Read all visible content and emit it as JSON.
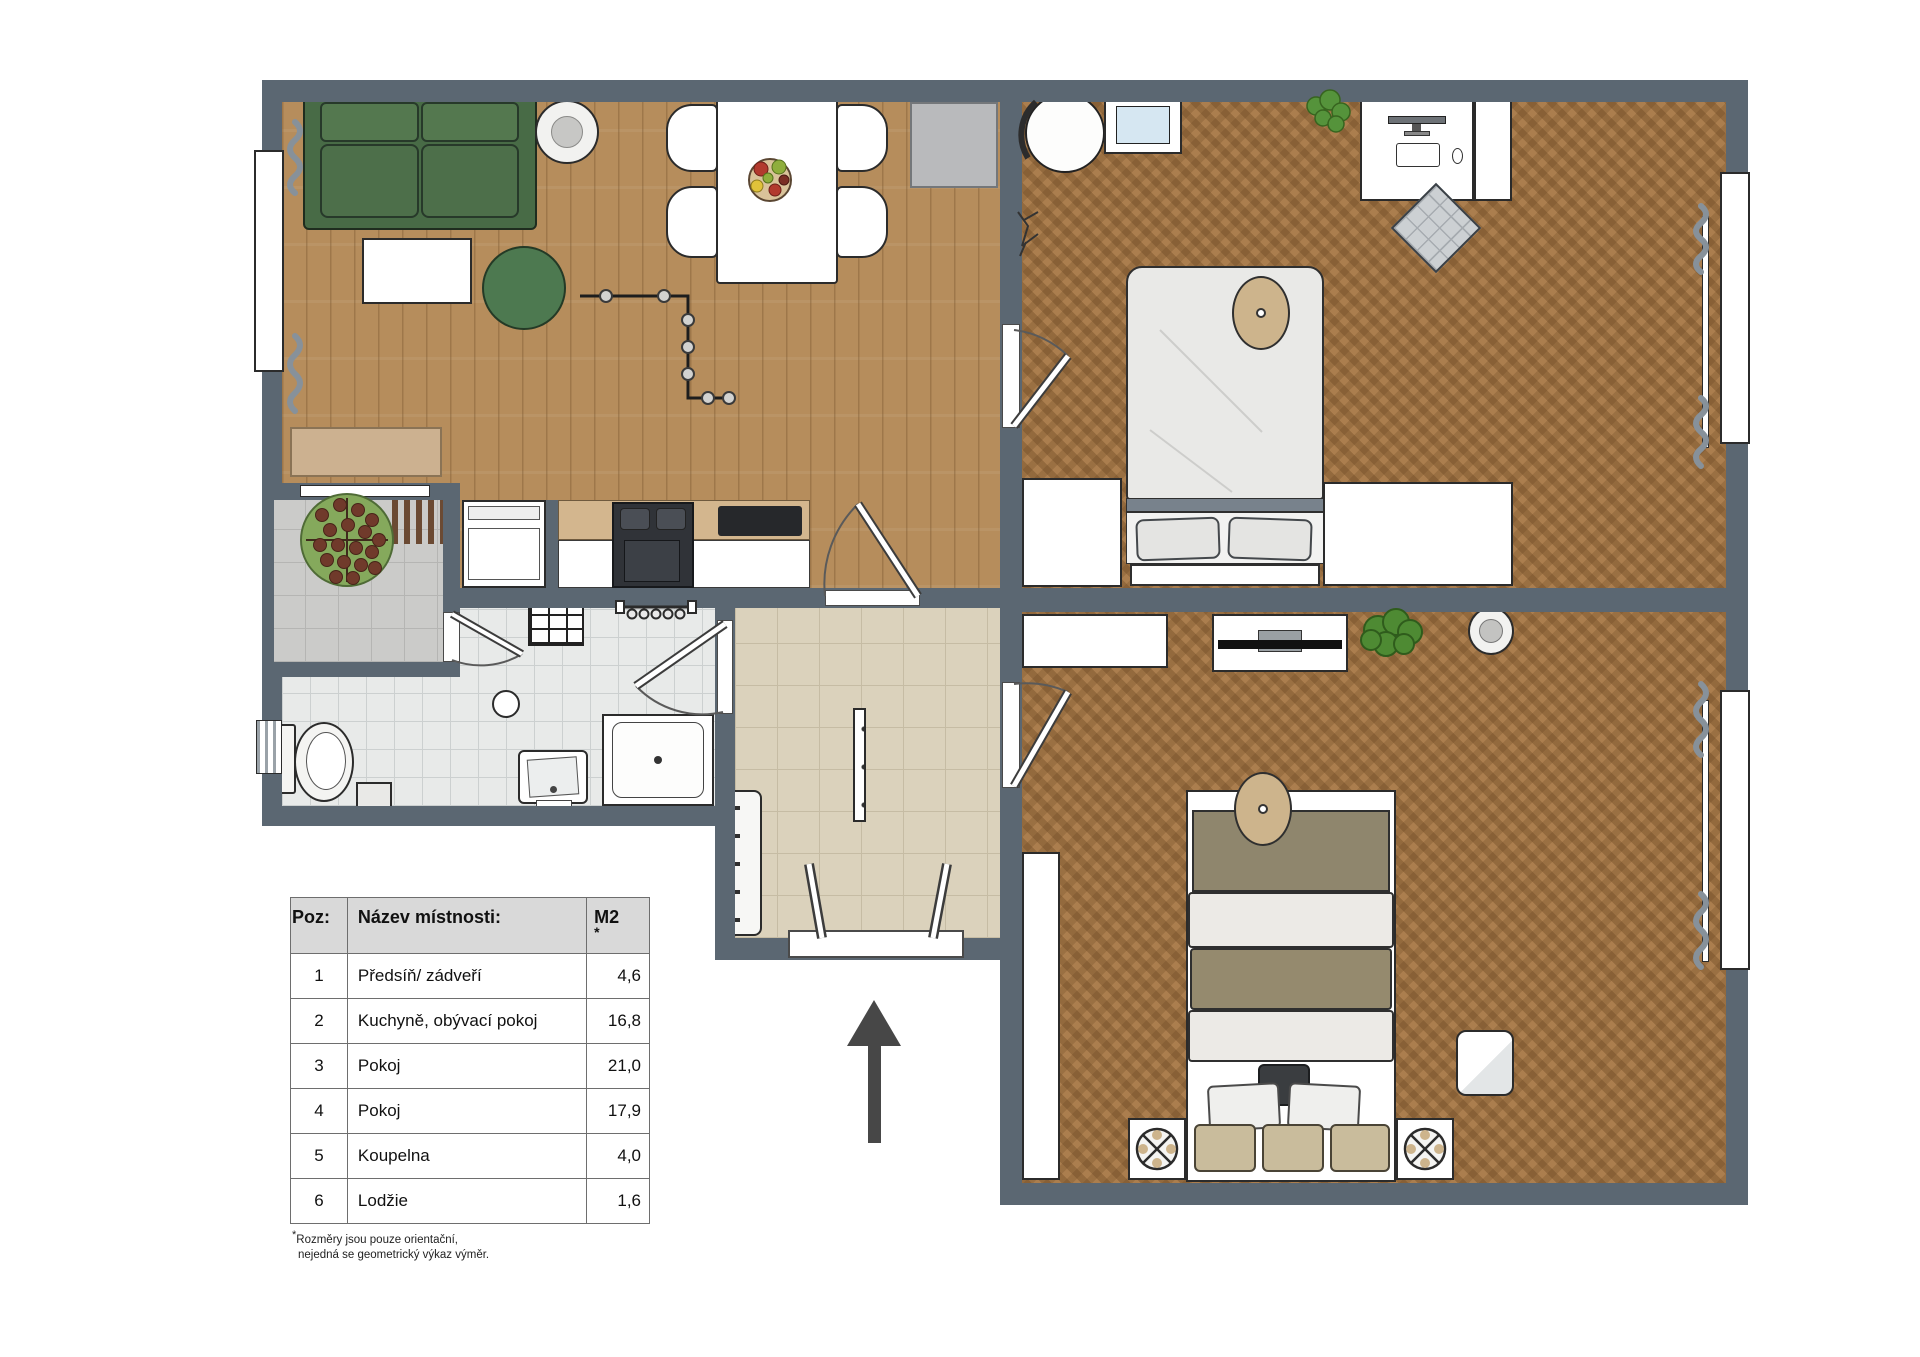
{
  "legend": {
    "headers": {
      "poz": "Poz:",
      "name": "Název místnosti:",
      "m2": "M2",
      "m2_star": "*"
    },
    "rows": [
      {
        "poz": "1",
        "name": "Předsíň/ zádveří",
        "m2": "4,6"
      },
      {
        "poz": "2",
        "name": "Kuchyně, obývací pokoj",
        "m2": "16,8"
      },
      {
        "poz": "3",
        "name": "Pokoj",
        "m2": "21,0"
      },
      {
        "poz": "4",
        "name": "Pokoj",
        "m2": "17,9"
      },
      {
        "poz": "5",
        "name": "Koupelna",
        "m2": "4,0"
      },
      {
        "poz": "6",
        "name": "Lodžie",
        "m2": "1,6"
      }
    ],
    "footnote_mark": "*",
    "footnote_line1": "Rozměry jsou pouze orientační,",
    "footnote_line2": "nejedná se geometrický výkaz výměr."
  },
  "colors": {
    "wall": "#5b6772",
    "wood_floor": "#b68d5c",
    "herringbone_floor": "#ab7e4e",
    "bath_tile": "#e8eae9",
    "hall_tile": "#dbd2bc",
    "loggia_tile": "#cbcbc9",
    "sofa_green": "#4d6f4a",
    "rug_green": "#4d7950",
    "north_arrow": "#474747"
  }
}
